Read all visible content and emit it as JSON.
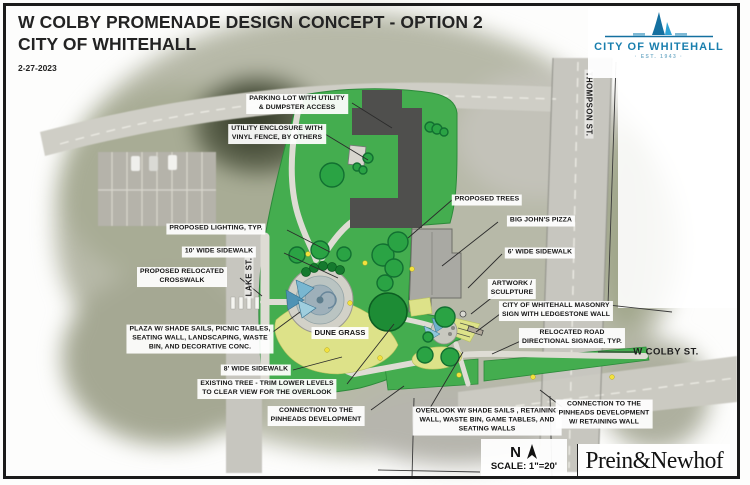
{
  "header": {
    "title_line1": "W COLBY PROMENADE DESIGN CONCEPT - OPTION 2",
    "title_line2": "CITY OF WHITEHALL",
    "date": "2-27-2023"
  },
  "logo": {
    "name": "CITY OF WHITEHALL",
    "est": "· EST. 1943 ·",
    "icon": "sailboat-icon",
    "color": "#1a7fae",
    "color_light": "#2fa3d4"
  },
  "callouts": {
    "parking_lot": "PARKING LOT WITH UTILITY\n& DUMPSTER ACCESS",
    "utility_enclosure": "UTILITY ENCLOSURE WITH\nVINYL FENCE, BY OTHERS",
    "proposed_trees": "PROPOSED TREES",
    "big_johns_pizza": "BIG JOHN'S PIZZA",
    "sidewalk_6": "6' WIDE SIDEWALK",
    "proposed_lighting": "PROPOSED LIGHTING, TYP.",
    "sidewalk_10": "10' WIDE SIDEWALK",
    "relocated_crosswalk": "PROPOSED RELOCATED\nCROSSWALK",
    "plaza": "PLAZA W/ SHADE SAILS, PICNIC TABLES,\nSEATING WALL, LANDSCAPING, WASTE\nBIN, AND DECORATIVE CONC.",
    "dune_grass": "DUNE GRASS",
    "sidewalk_8": "8' WIDE SIDEWALK",
    "existing_tree": "EXISTING TREE - TRIM LOWER LEVELS\nTO CLEAR VIEW FOR THE OVERLOOK",
    "connection_pinheads": "CONNECTION TO THE\nPINHEADS DEVELOPMENT",
    "overlook": "OVERLOOK W/ SHADE SAILS , RETAINING\nWALL, WASTE BIN, GAME TABLES, AND\nSEATING WALLS",
    "artwork": "ARTWORK /\nSCULPTURE",
    "masonry_sign": "CITY OF WHITEHALL MASONRY\nSIGN WITH LEDGESTONE WALL",
    "road_signage": "RELOCATED ROAD\nDIRECTIONAL SIGNAGE, TYP.",
    "connection_retaining": "CONNECTION TO THE\nPINHEADS DEVELOPMENT\nW/ RETAINING WALL"
  },
  "streets": {
    "lake": "LAKE ST.",
    "thompson": "THOMPSON ST.",
    "w_colby": "W COLBY ST."
  },
  "compass": {
    "north": "N",
    "scale": "SCALE: 1\"=20'"
  },
  "firm": {
    "name": "Prein&Newhof"
  },
  "colors": {
    "turf_green": "#44ad4f",
    "dune_grass": "#dde289",
    "tree_green": "#2aa344",
    "asphalt_dark": "#4f4f4d",
    "road_gray": "#cbcac2",
    "shade_sail_blue": "#5f9fc0",
    "lighting_yellow": "#f2e13d",
    "logo_blue": "#1a7fae"
  }
}
